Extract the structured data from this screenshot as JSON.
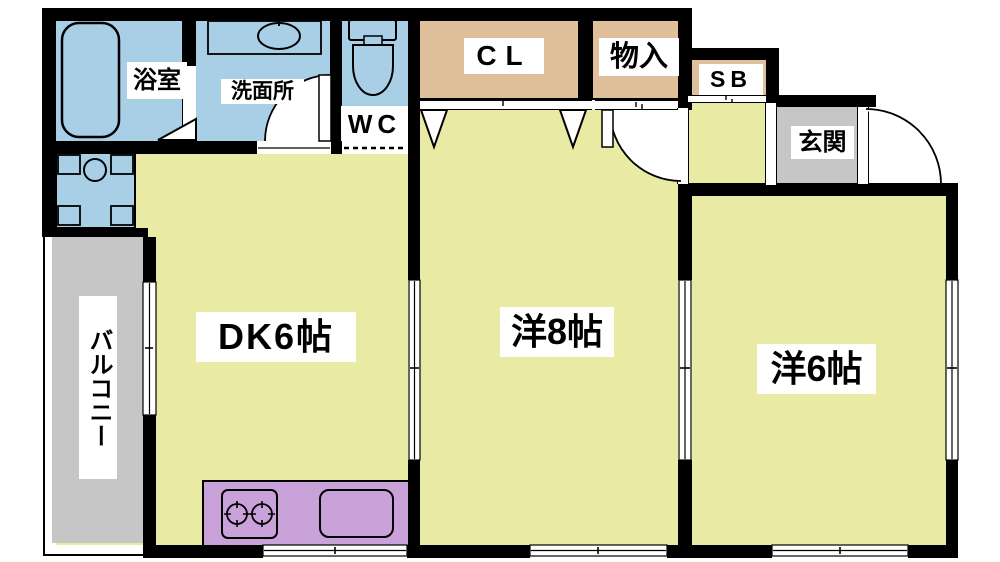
{
  "plan": {
    "title": "2DK apartment floor plan",
    "labels": {
      "bathroom": "浴室",
      "washroom": "洗面所",
      "wc": "WC",
      "closet": "CL",
      "storage": "物入",
      "shoe_box": "SB",
      "entrance": "玄関",
      "dining_kitchen": "DK6帖",
      "western_room_8": "洋8帖",
      "western_room_6": "洋6帖",
      "balcony": "バルコニー"
    },
    "fixtures": [
      "bathtub",
      "washbasin",
      "toilet",
      "washing-machine-pan",
      "gas-stove",
      "kitchen-sink"
    ],
    "colors": {
      "wall": "#000000",
      "room-yellow": "#e9eba4",
      "water-blue": "#a9cfe6",
      "closet-tan": "#dfc09a",
      "entry-gray": "#c6c6c6",
      "kitchen-purple": "#c9a2da",
      "label-bg": "#ffffff"
    }
  }
}
